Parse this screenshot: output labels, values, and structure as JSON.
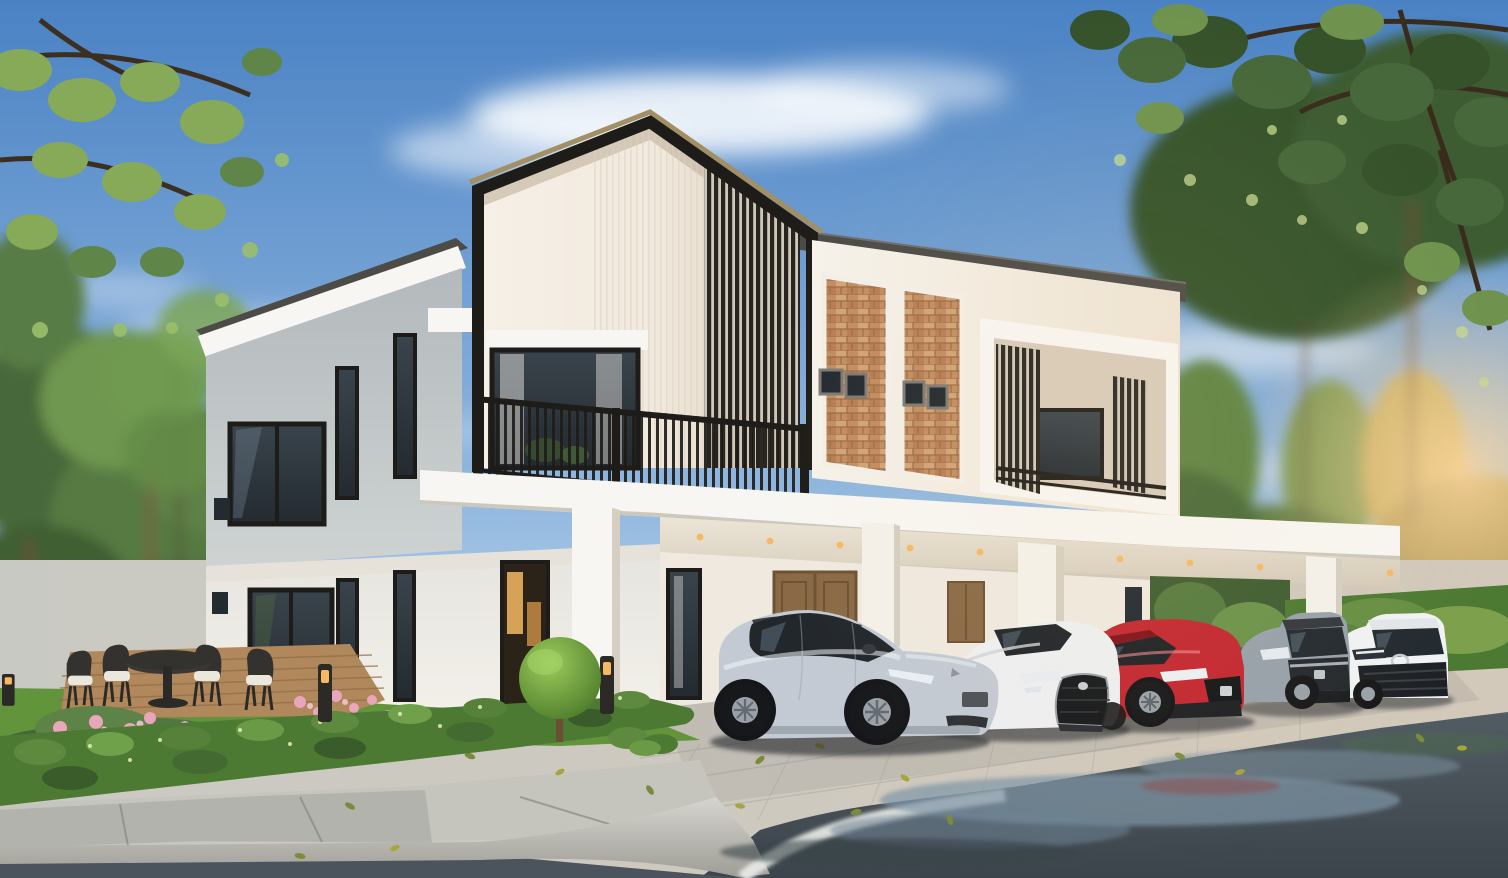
{
  "scene": {
    "kind": "3d-architectural-exterior-rendering",
    "subject": "Modern two-storey terrace houses with a black steel gable frame, vertical slat screens, brick accent panels and a long carport sheltering five parked cars",
    "setting": "Corner lot with lawn, clipped hedge, flower bed, timber deck with outdoor dining set, kerbed sidewalk and a wet asphalt road in the foreground",
    "lighting": "Daytime, partly cloudy blue sky, warm sunlight entering from the right, tree branches framing the top corners"
  },
  "palette": {
    "sky_top": "#4a82c4",
    "sky_mid": "#8fb6de",
    "sky_horizon": "#ddecf7",
    "cloud_white": "#ffffff",
    "foliage_dark": "#35522b",
    "foliage_mid": "#5d8342",
    "foliage_light": "#86aa58",
    "foliage_warm": "#b7a353",
    "sun_glow": "#ffd9a0",
    "wall_white": "#f5f2ec",
    "wall_cream": "#f1e9dd",
    "wall_grey": "#b3b9bc",
    "fascia_white": "#f8f6f2",
    "roof_dark": "#4c4b47",
    "frame_black": "#1e1c18",
    "frame_bronze": "#a28f63",
    "slat_dark": "#282520",
    "brick_base": "#c28c60",
    "brick_line": "#9c6a44",
    "brick_light": "#e2c094",
    "glass_dark": "#232a30",
    "glass_sky": "#8fa9bc",
    "curtain_white": "#e8e6e0",
    "door_wood": "#8a6a46",
    "warm_light": "#f5b964",
    "lawn_green": "#61943b",
    "hedge_green": "#4d7a33",
    "flower_pink": "#e9a6ba",
    "deck_wood": "#b0885c",
    "furniture_dark": "#34322e",
    "cushion_white": "#eae7dd",
    "pavement_light": "#c9c9c3",
    "pavement_shade": "#a0a19b",
    "curb_concrete": "#d6d5cf",
    "road_marking": "#e9eae6",
    "road_wet": "#525c63",
    "road_dark": "#3c444b",
    "puddle_sky": "#7e95a6",
    "tyre_black": "#17181a",
    "rim_silver": "#9aa1a8"
  },
  "vehicles": [
    {
      "name": "silver-crossover",
      "body": "#c3cad3"
    },
    {
      "name": "white-sports-sedan",
      "body": "#edeff1"
    },
    {
      "name": "red-compact-sedan",
      "body": "#c22730"
    },
    {
      "name": "grey-compact-suv",
      "body": "#97a1ab"
    },
    {
      "name": "white-crossover-suv",
      "body": "#f0f2f4"
    }
  ],
  "house": {
    "storeys": 2,
    "features": [
      "black-steel-gable-frame",
      "vertical-slat-screens",
      "glass-balconies",
      "brick-accent-panels",
      "carport-canopy-with-downlights",
      "timber-entry-doors",
      "floor-to-ceiling-windows"
    ]
  },
  "landscape": {
    "features": [
      "overhanging-branches",
      "background-trees",
      "lawn",
      "clipped-hedge",
      "flower-bed",
      "timber-deck",
      "outdoor-dining-set",
      "bollard-lights",
      "topiary-tree",
      "kerbed-sidewalk",
      "wet-road-with-puddles",
      "fallen-leaves"
    ]
  }
}
